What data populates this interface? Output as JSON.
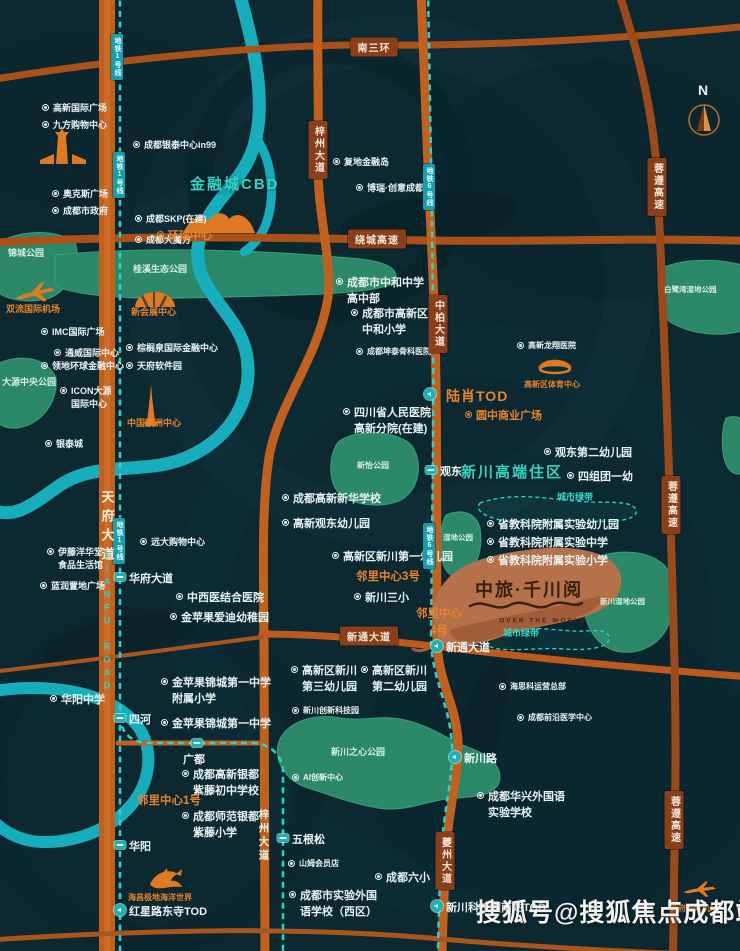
{
  "title": "中旅·千川阅 区位图",
  "project": {
    "name": "中旅·千川阅",
    "subtitle": "OVER THE WORLD"
  },
  "compass": {
    "label": "N"
  },
  "watermark": {
    "text": "搜狐号@搜狐焦点成都站"
  },
  "colors": {
    "background": "#0c2931",
    "road": "#c2601e",
    "highway": "#9c4a1a",
    "river": "#16aebd",
    "metro": "#2bd3cd",
    "park": "#2d8c6c",
    "accent_orange": "#e8832b",
    "accent_teal": "#2fd6c5",
    "copper_logo": "#b5714a"
  },
  "labels": [
    {
      "ty": "poi",
      "t": "高新国际广场",
      "x": 42,
      "y": 102
    },
    {
      "ty": "poi",
      "t": "九方购物中心",
      "x": 42,
      "y": 119
    },
    {
      "ty": "poi",
      "t": "成都银泰中心in99",
      "x": 133,
      "y": 139
    },
    {
      "ty": "poi",
      "t": "奥克斯广场",
      "x": 52,
      "y": 188
    },
    {
      "ty": "poi",
      "t": "成都市政府",
      "x": 52,
      "y": 205
    },
    {
      "ty": "poi",
      "t": "成都SKP(在建)",
      "x": 135,
      "y": 213
    },
    {
      "ty": "poi",
      "t": "成都大魔方",
      "x": 135,
      "y": 234
    },
    {
      "ty": "poi",
      "t": "IMC国际广场",
      "x": 41,
      "y": 326
    },
    {
      "ty": "poi",
      "t": "通威国际中心",
      "x": 54,
      "y": 347
    },
    {
      "ty": "poi",
      "t": "领地环球金融中心",
      "x": 41,
      "y": 360
    },
    {
      "ty": "poi",
      "lines": [
        "ICON大源",
        "国际中心"
      ],
      "x": 60,
      "y": 385
    },
    {
      "ty": "poi",
      "t": "银泰城",
      "x": 45,
      "y": 438
    },
    {
      "ty": "poi",
      "t": "棕榈泉国际金融中心",
      "x": 126,
      "y": 342
    },
    {
      "ty": "poi",
      "t": "天府软件园",
      "x": 126,
      "y": 360
    },
    {
      "ty": "poi",
      "lines": [
        "伊藤洋华堂",
        "食品生活馆"
      ],
      "x": 47,
      "y": 546,
      "s": 2
    },
    {
      "ty": "poi",
      "t": "蓝润置地广场",
      "x": 40,
      "y": 580
    },
    {
      "ty": "poi",
      "t": "远大购物中心",
      "x": 140,
      "y": 536
    },
    {
      "ty": "poi",
      "t": "中西医结合医院",
      "x": 176,
      "y": 591,
      "s": 3
    },
    {
      "ty": "poi",
      "t": "金苹果爱迪幼稚园",
      "x": 170,
      "y": 611,
      "s": 3
    },
    {
      "ty": "poi",
      "t": "华阳中学",
      "x": 50,
      "y": 693,
      "s": 3
    },
    {
      "ty": "poi",
      "lines": [
        "金苹果锦城第一中学",
        "附属小学"
      ],
      "x": 161,
      "y": 676,
      "s": 3
    },
    {
      "ty": "poi",
      "t": "金苹果锦城第一中学",
      "x": 161,
      "y": 717,
      "s": 3
    },
    {
      "ty": "poi",
      "lines": [
        "成都高新银都",
        "紫藤初中学校"
      ],
      "x": 182,
      "y": 768,
      "s": 3
    },
    {
      "ty": "poi",
      "lines": [
        "成都师范银都",
        "紫藤小学"
      ],
      "x": 182,
      "y": 810,
      "s": 3
    },
    {
      "ty": "poi",
      "t": "复地金融岛",
      "x": 333,
      "y": 156
    },
    {
      "ty": "poi",
      "t": "博瑞·创意成都",
      "x": 356,
      "y": 182
    },
    {
      "ty": "poi",
      "lines": [
        "成都市中和中学",
        "高中部"
      ],
      "x": 336,
      "y": 276,
      "s": 3
    },
    {
      "ty": "poi",
      "lines": [
        "成都市高新区",
        "中和小学"
      ],
      "x": 351,
      "y": 307,
      "s": 3
    },
    {
      "ty": "poi",
      "t": "成都坤泰骨科医院",
      "x": 356,
      "y": 346,
      "s": 1
    },
    {
      "ty": "poi",
      "lines": [
        "四川省人民医院",
        "高新分院(在建)"
      ],
      "x": 343,
      "y": 406,
      "s": 3
    },
    {
      "ty": "poi",
      "t": "成都高新新华学校",
      "x": 282,
      "y": 492,
      "s": 3
    },
    {
      "ty": "poi",
      "t": "高新观东幼儿园",
      "x": 282,
      "y": 517,
      "s": 3
    },
    {
      "ty": "poi",
      "t": "高新区新川第一幼儿园",
      "x": 332,
      "y": 550,
      "s": 3
    },
    {
      "ty": "poi",
      "t": "新川三小",
      "x": 354,
      "y": 591,
      "s": 3
    },
    {
      "ty": "poi",
      "t": "观东第二幼儿园",
      "x": 544,
      "y": 446,
      "s": 3
    },
    {
      "ty": "poi",
      "t": "四组团一幼",
      "x": 567,
      "y": 470,
      "s": 3
    },
    {
      "ty": "poi",
      "t": "省教科院附属实验幼儿园",
      "x": 487,
      "y": 518,
      "s": 3
    },
    {
      "ty": "poi",
      "t": "省教科院附属实验中学",
      "x": 487,
      "y": 536,
      "s": 3
    },
    {
      "ty": "poi",
      "t": "省教科院附属实验小学",
      "x": 487,
      "y": 554,
      "s": 3
    },
    {
      "ty": "poi",
      "lines": [
        "高新区新川",
        "第三幼儿园"
      ],
      "x": 291,
      "y": 664,
      "s": 3
    },
    {
      "ty": "poi",
      "lines": [
        "高新区新川",
        "第二幼儿园"
      ],
      "x": 361,
      "y": 664,
      "s": 3
    },
    {
      "ty": "poi",
      "t": "新川创新科技园",
      "x": 292,
      "y": 705,
      "s": 1
    },
    {
      "ty": "poi",
      "t": "AI创新中心",
      "x": 292,
      "y": 772,
      "s": 1
    },
    {
      "ty": "poi",
      "t": "海思科运营总部",
      "x": 499,
      "y": 681,
      "s": 1
    },
    {
      "ty": "poi",
      "t": "成都前沿医学中心",
      "x": 517,
      "y": 712,
      "s": 1
    },
    {
      "ty": "poi",
      "lines": [
        "成都华兴外国语",
        "实验学校"
      ],
      "x": 477,
      "y": 790,
      "s": 3
    },
    {
      "ty": "poi",
      "t": "成都六小",
      "x": 375,
      "y": 871,
      "s": 3
    },
    {
      "ty": "poi",
      "lines": [
        "成都市实验外国",
        "语学校（西区）"
      ],
      "x": 289,
      "y": 889,
      "s": 3
    },
    {
      "ty": "poi",
      "t": "山姆会员店",
      "x": 288,
      "y": 858,
      "s": 1
    },
    {
      "ty": "poi",
      "t": "高新龙翔医院",
      "x": 517,
      "y": 340,
      "s": 1
    },
    {
      "ty": "poi",
      "o": 1,
      "t": "环球中心",
      "x": 157,
      "y": 229,
      "s": 3
    },
    {
      "ty": "poi",
      "o": 1,
      "t": "圆中商业广场",
      "x": 465,
      "y": 409,
      "s": 3
    },
    {
      "ty": "txt",
      "n": "landmark-label",
      "cls": "orange s2",
      "t": "双流国际机场",
      "x": 6,
      "y": 303
    },
    {
      "ty": "txt",
      "n": "landmark-label",
      "cls": "orange s2",
      "t": "新会展中心",
      "x": 131,
      "y": 306
    },
    {
      "ty": "txt",
      "n": "landmark-label",
      "cls": "orange s2",
      "t": "中国欧洲中心",
      "x": 127,
      "y": 417
    },
    {
      "ty": "txt",
      "n": "landmark-label",
      "cls": "orange s1",
      "t": "海昌极地海洋世界",
      "x": 128,
      "y": 892
    },
    {
      "ty": "txt",
      "n": "landmark-label",
      "cls": "orange s1",
      "t": "高新区体育中心",
      "x": 524,
      "y": 379
    },
    {
      "ty": "txt",
      "n": "landmark-label",
      "cls": "orange s1",
      "t": "天府国际机场",
      "x": 670,
      "y": 903
    },
    {
      "ty": "txt",
      "n": "neighborhood-center-label",
      "cls": "orange nb13",
      "t": "邻里中心1号",
      "x": 137,
      "y": 793
    },
    {
      "ty": "txt",
      "n": "neighborhood-center-label",
      "cls": "orange nb13",
      "t": "邻里中心3号",
      "x": 356,
      "y": 569
    },
    {
      "ty": "txt",
      "n": "neighborhood-center-label",
      "cls": "orange nb13 ctr",
      "lines": [
        "邻里中心",
        "4号"
      ],
      "x": 413,
      "y": 606
    },
    {
      "ty": "txt",
      "n": "landmark-label",
      "cls": "orange big",
      "t": "陆肖TOD",
      "x": 446,
      "y": 386
    },
    {
      "ty": "txt",
      "n": "district-label",
      "cls": "teal-head",
      "t": "金融城CBD",
      "x": 190,
      "y": 174
    },
    {
      "ty": "txt",
      "n": "district-label",
      "cls": "teal-head",
      "t": "新川高端住区",
      "x": 461,
      "y": 462
    },
    {
      "ty": "txt",
      "n": "park-label",
      "cls": "park-lbl s2",
      "t": "锦城公园",
      "x": 8,
      "y": 247
    },
    {
      "ty": "txt",
      "n": "park-label",
      "cls": "park-lbl s2",
      "t": "桂溪生态公园",
      "x": 133,
      "y": 263
    },
    {
      "ty": "txt",
      "n": "park-label",
      "cls": "park-lbl s2",
      "t": "大源中央公园",
      "x": 2,
      "y": 376
    },
    {
      "ty": "txt",
      "n": "park-label",
      "cls": "park-lbl s1",
      "t": "新怡公园",
      "x": 357,
      "y": 460
    },
    {
      "ty": "txt",
      "n": "park-label",
      "cls": "park-lbl s0",
      "t": "湿地公园",
      "x": 443,
      "y": 533
    },
    {
      "ty": "txt",
      "n": "park-label",
      "cls": "park-lbl s0",
      "t": "白鹭湾湿地公园",
      "x": 664,
      "y": 285
    },
    {
      "ty": "txt",
      "n": "park-label",
      "cls": "park-lbl s0",
      "t": "新川湿地公园",
      "x": 600,
      "y": 597
    },
    {
      "ty": "txt",
      "n": "park-label",
      "cls": "park-lbl s2",
      "t": "新川之心公园",
      "x": 331,
      "y": 746
    },
    {
      "ty": "txt",
      "n": "greenbelt-label",
      "cls": "belt-lbl",
      "t": "城市绿带",
      "x": 557,
      "y": 491
    },
    {
      "ty": "txt",
      "n": "greenbelt-label",
      "cls": "belt-lbl",
      "t": "城市绿带",
      "x": 503,
      "y": 627
    },
    {
      "ty": "badge",
      "t": "南三环",
      "x": 374,
      "y": 47
    },
    {
      "ty": "badge",
      "t": "绕城高速",
      "x": 377,
      "y": 239
    },
    {
      "ty": "badge",
      "t": "新通大道",
      "x": 369,
      "y": 636
    },
    {
      "ty": "badge",
      "v": 1,
      "t": "梓州大道",
      "x": 318,
      "y": 150
    },
    {
      "ty": "badge",
      "v": 1,
      "t": "中柏大道",
      "x": 438,
      "y": 324
    },
    {
      "ty": "badge",
      "v": 1,
      "t": "夔州大道",
      "x": 445,
      "y": 861
    },
    {
      "ty": "badge",
      "v": 1,
      "t": "蓉遵高速",
      "x": 657,
      "y": 187
    },
    {
      "ty": "badge",
      "v": 1,
      "t": "蓉遵高速",
      "x": 671,
      "y": 505
    },
    {
      "ty": "badge",
      "v": 1,
      "t": "蓉遵高速",
      "x": 674,
      "y": 820
    },
    {
      "ty": "badge",
      "v": 1,
      "m": 1,
      "t": "地铁1号线",
      "x": 117,
      "y": 57
    },
    {
      "ty": "badge",
      "v": 1,
      "m": 1,
      "t": "地铁1号线",
      "x": 119,
      "y": 175
    },
    {
      "ty": "badge",
      "v": 1,
      "m": 1,
      "t": "地铁1号线",
      "x": 119,
      "y": 541
    },
    {
      "ty": "badge",
      "v": 1,
      "m": 1,
      "t": "地铁6号线",
      "x": 429,
      "y": 187
    },
    {
      "ty": "badge",
      "v": 1,
      "m": 1,
      "t": "地铁6号线",
      "x": 429,
      "y": 546
    },
    {
      "ty": "roadv",
      "cls": "big",
      "t": "天府大道",
      "x": 107,
      "y": 528
    },
    {
      "ty": "roadv",
      "cls": "en",
      "t": "TIANFU ROAD",
      "x": 107,
      "y": 622
    },
    {
      "ty": "roadv",
      "cls": "mid",
      "t": "梓州大道",
      "x": 264,
      "y": 836
    },
    {
      "ty": "st",
      "m": "sq",
      "t": "华府大道",
      "x": 120,
      "y": 577
    },
    {
      "ty": "st",
      "m": "sq",
      "t": "四河",
      "x": 120,
      "y": 718
    },
    {
      "ty": "st",
      "m": "sq",
      "t": "广都",
      "x": 197,
      "y": 743,
      "side": "b"
    },
    {
      "ty": "st",
      "m": "sq",
      "t": "华阳",
      "x": 120,
      "y": 845
    },
    {
      "ty": "st",
      "m": "sq",
      "t": "五根松",
      "x": 283,
      "y": 838
    },
    {
      "ty": "st",
      "m": "sq",
      "t": "观东",
      "x": 431,
      "y": 470
    },
    {
      "ty": "st",
      "m": "ci",
      "t": "",
      "x": 430,
      "y": 394
    },
    {
      "ty": "st",
      "m": "ci",
      "t": "新通大道",
      "x": 437,
      "y": 646
    },
    {
      "ty": "st",
      "m": "ci",
      "t": "新川路",
      "x": 455,
      "y": 757
    },
    {
      "ty": "st",
      "m": "ci",
      "t": "红星路东寺TOD",
      "x": 120,
      "y": 910
    },
    {
      "ty": "st",
      "m": "ci",
      "t": "新川科技园南站TOD",
      "x": 437,
      "y": 906
    }
  ]
}
